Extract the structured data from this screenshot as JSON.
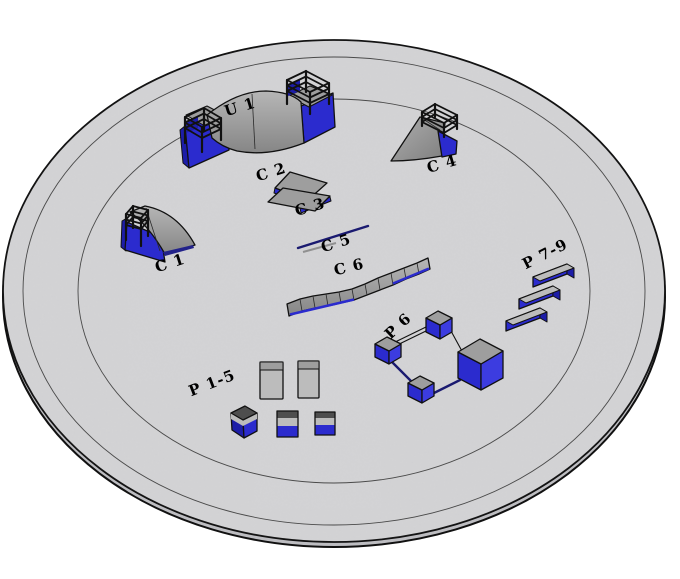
{
  "objects": [
    {
      "id": "u1",
      "label": "U 1",
      "shape": "half-pipe"
    },
    {
      "id": "c1",
      "label": "C 1",
      "shape": "quarter-pipe"
    },
    {
      "id": "c2",
      "label": "C 2",
      "shape": "bank-ramp"
    },
    {
      "id": "c3",
      "label": "C 3",
      "shape": "bank-ramp"
    },
    {
      "id": "c4",
      "label": "C 4",
      "shape": "quarter-pipe"
    },
    {
      "id": "c5",
      "label": "C 5",
      "shape": "flat-rail"
    },
    {
      "id": "c6",
      "label": "C 6",
      "shape": "segmented-ledge"
    },
    {
      "id": "p15",
      "label": "P 1-5",
      "shape": "boxes-and-pads"
    },
    {
      "id": "p6",
      "label": "P 6",
      "shape": "box-rail-course"
    },
    {
      "id": "p79",
      "label": "P 7-9",
      "shape": "triple-ledges"
    }
  ],
  "palette": {
    "ground": "#d4d4d6",
    "groundSide": "#bdbdc1",
    "blue": "#2b2bce",
    "blueBright": "#3c3ce0",
    "blueDark": "#1d1da8",
    "gray": "#9e9e9e",
    "grayLight": "#bcbcbc",
    "grayDark": "#4e4e4e",
    "outline": "#111111",
    "navy": "#1a1a70",
    "ring": "#4a4a4a",
    "background": "#ffffff",
    "labelColor": "#000000"
  }
}
